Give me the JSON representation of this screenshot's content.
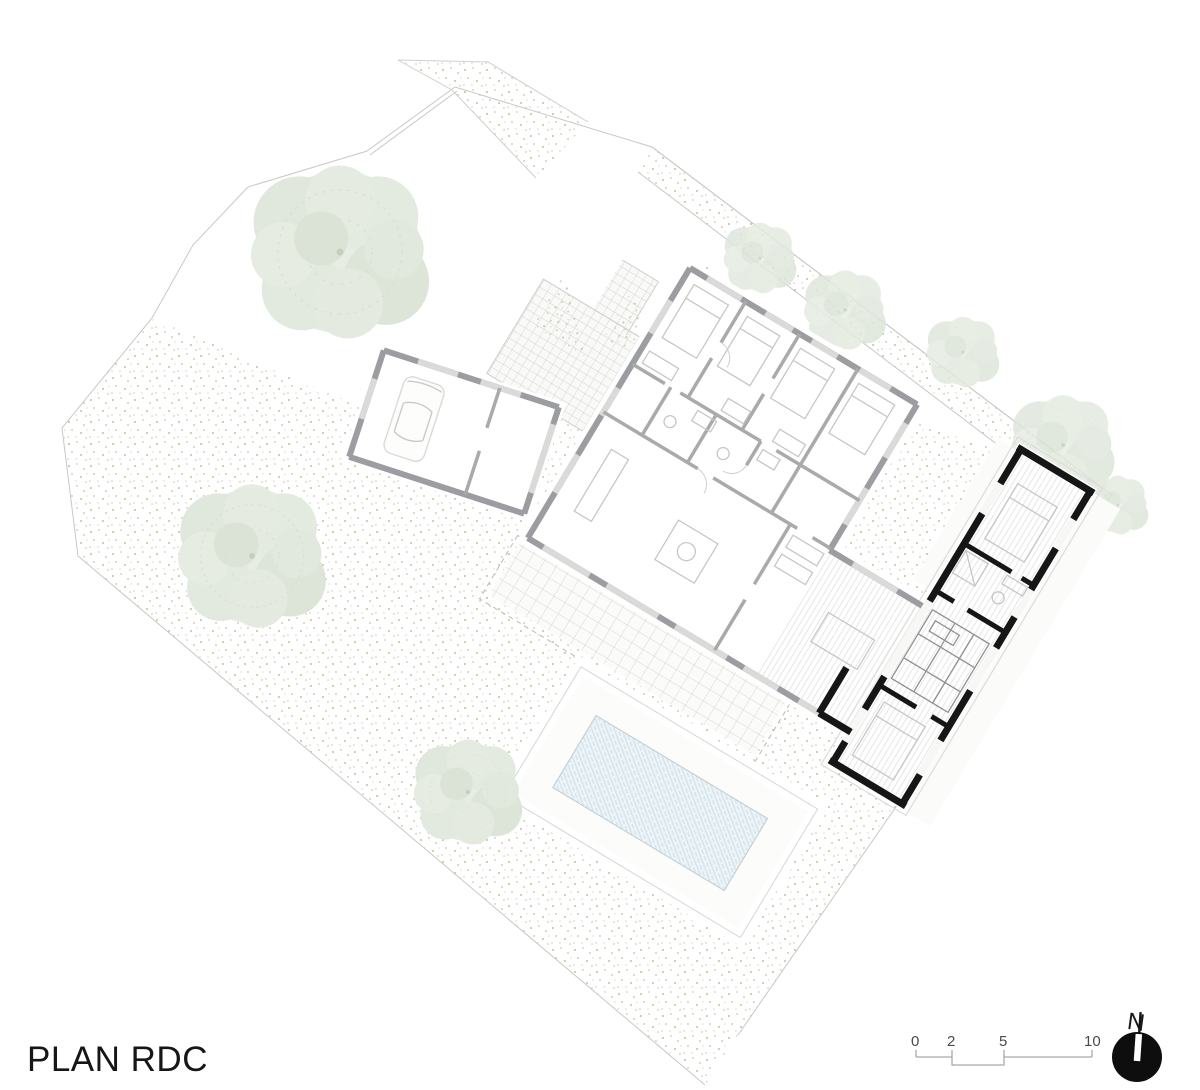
{
  "title": "PLAN RDC",
  "scale_bar": {
    "labels": [
      "0",
      "2",
      "5",
      "10"
    ]
  },
  "north_arrow": {
    "label": "N"
  },
  "drawing": {
    "colors": {
      "existing_walls": "#9b9da1",
      "new_walls": "#161616",
      "pool_water": "#eef4f7",
      "stipple_olive": "#cfc9a4",
      "stipple_green": "#ccd4c0",
      "stipple_gray": "#c8ccc0",
      "tree_foliage": "#e3e9e0",
      "tile_line": "#d6d8d4",
      "boundary_line": "#c7c9c6"
    }
  }
}
